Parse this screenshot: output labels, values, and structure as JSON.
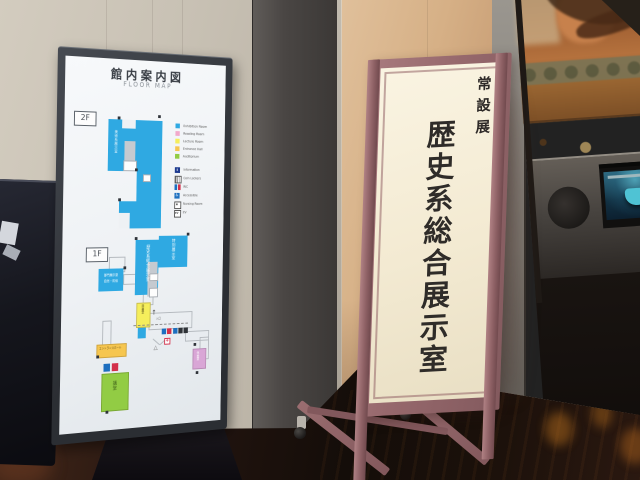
{
  "scene": {
    "setting": "Museum lobby with a digital floor-map display and a permanent-exhibition standing sign"
  },
  "floor_map": {
    "title": "館内案内図",
    "subtitle": "FLOOR MAP",
    "floor2_label": "2F",
    "floor1_label": "1F",
    "rooms": {
      "f2_exhibition": "美術系展示室",
      "f1_main_exhibition": "歴史系総合展示室",
      "f1_special_exhibition": "特別展示室",
      "f1_dept_exhibition_line1": "部門展示室",
      "f1_dept_exhibition_line2": "自然・民俗",
      "f1_library": "図書室",
      "f1_entrance_hall": "エントランスホール",
      "f1_auditorium": "講堂",
      "f1_lounge": "休憩室",
      "route_entrance": "入口"
    },
    "legend_colors": [
      {
        "color": "#2fa9e2",
        "label": "Exhibition Room"
      },
      {
        "color": "#f2a9cb",
        "label": "Reading Room"
      },
      {
        "color": "#f5ee5c",
        "label": "Lecture Room"
      },
      {
        "color": "#f6c64f",
        "label": "Entrance Hall"
      },
      {
        "color": "#92cc44",
        "label": "Auditorium"
      }
    ],
    "legend_facilities": [
      {
        "icon": "information-icon",
        "label": "Information"
      },
      {
        "icon": "locker-icon",
        "label": "Coin Lockers"
      },
      {
        "icon": "toilet-icon",
        "label": "WC"
      },
      {
        "icon": "wheelchair-icon",
        "label": "Accessible"
      },
      {
        "icon": "nursing-icon",
        "label": "Nursing Room"
      },
      {
        "icon": "elevator-icon",
        "label": "EV"
      }
    ]
  },
  "standing_sign": {
    "category": "常設展",
    "title": "歴史系総合展示室",
    "frame_color": "#96686c",
    "panel_color": "#f6eedb"
  },
  "icons": {
    "male": "♂",
    "female": "♀",
    "accessible": "♿",
    "info": "i",
    "ev": "EV",
    "arrow": "↑"
  },
  "colors": {
    "map_room_blue": "#2fa9e2",
    "wall_tan": "#d6b086",
    "floor_dark": "#1a100a"
  }
}
